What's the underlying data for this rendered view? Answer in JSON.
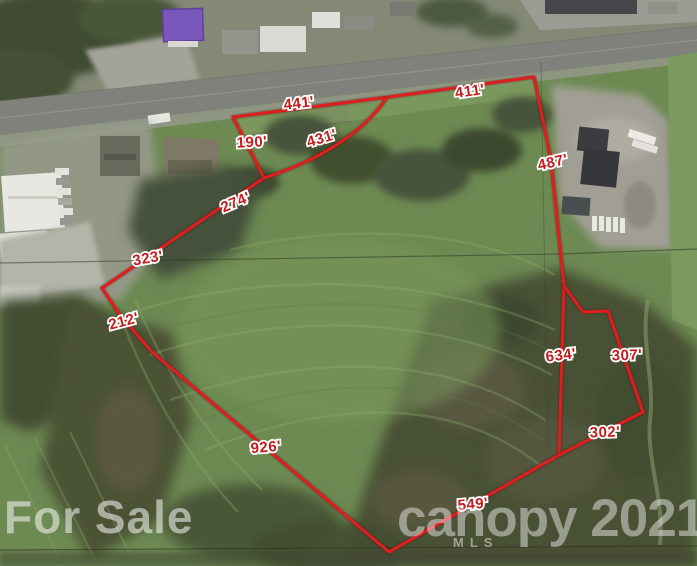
{
  "watermarks": {
    "for_sale": "For Sale",
    "brand": "canopy 2021",
    "brand_sub": "MLS"
  },
  "parcel": {
    "line_color": "#dd1f1f",
    "label_color": "#c41c1c",
    "outline_main_points": "233,117 389,97 534,77 551,160 564,286 559,455 389,552 152,352 120,315 102,288 183,233 264,178 233,117",
    "interior_line_431_path": "M264,178 Q350,150 386,99",
    "east_notch_points": "564,286 583,312 608,311 643,412 559,455",
    "measurements": [
      {
        "text": "441'",
        "x": 299,
        "y": 104,
        "rot": -7
      },
      {
        "text": "411'",
        "x": 470,
        "y": 92,
        "rot": -8
      },
      {
        "text": "190'",
        "x": 252,
        "y": 143,
        "rot": -3
      },
      {
        "text": "431'",
        "x": 322,
        "y": 139,
        "rot": -17
      },
      {
        "text": "274'",
        "x": 236,
        "y": 203,
        "rot": -23
      },
      {
        "text": "487'",
        "x": 553,
        "y": 163,
        "rot": -13
      },
      {
        "text": "323'",
        "x": 148,
        "y": 259,
        "rot": -10
      },
      {
        "text": "212'",
        "x": 124,
        "y": 322,
        "rot": -15
      },
      {
        "text": "634'",
        "x": 561,
        "y": 356,
        "rot": -7
      },
      {
        "text": "307'",
        "x": 627,
        "y": 356,
        "rot": -2
      },
      {
        "text": "302'",
        "x": 605,
        "y": 433,
        "rot": -2
      },
      {
        "text": "926'",
        "x": 266,
        "y": 448,
        "rot": -5
      },
      {
        "text": "549'",
        "x": 473,
        "y": 505,
        "rot": -5
      }
    ]
  }
}
